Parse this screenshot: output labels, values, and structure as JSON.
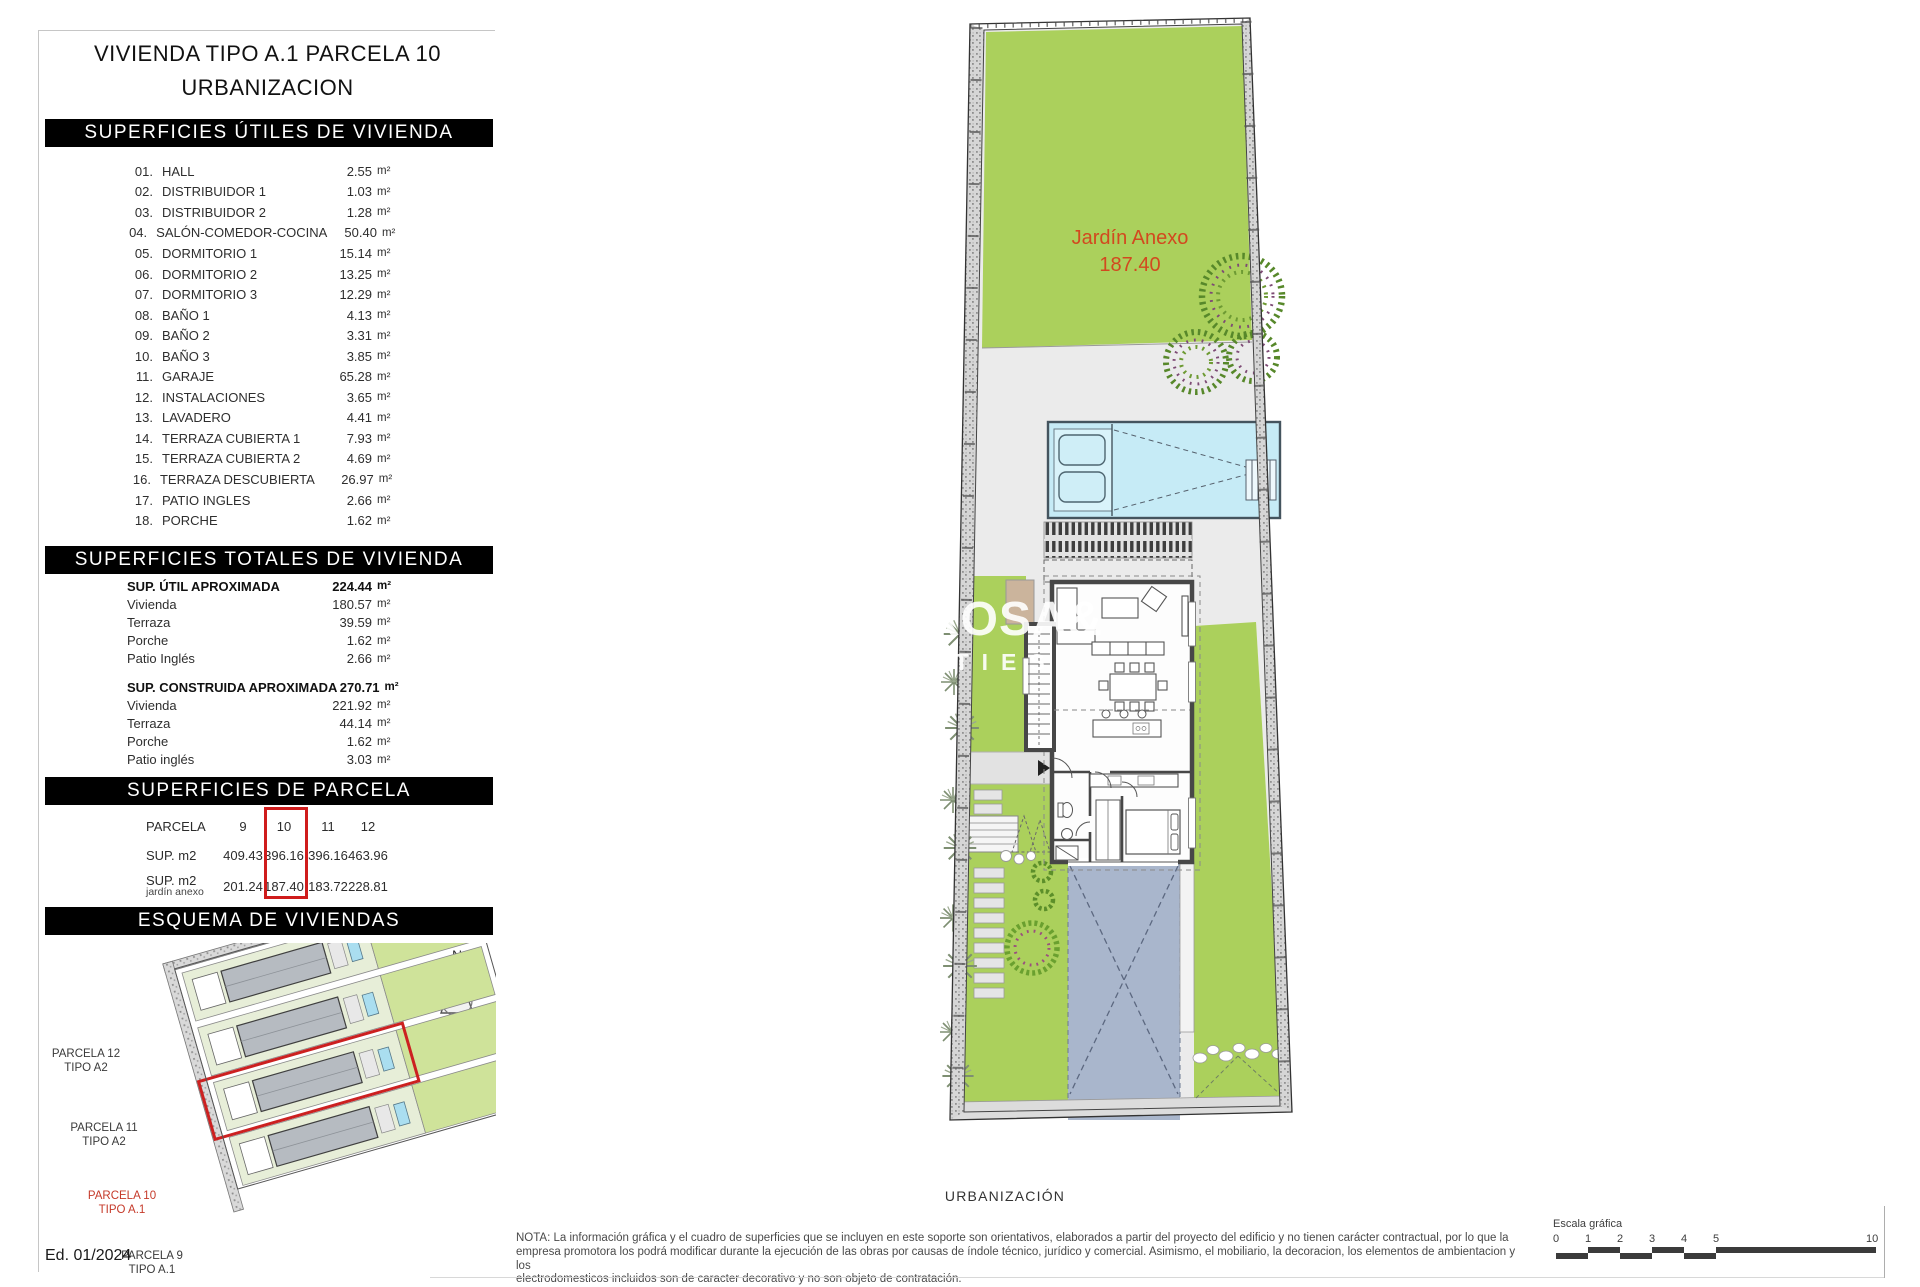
{
  "title": {
    "line1": "VIVIENDA TIPO A.1 PARCELA 10",
    "line2": "URBANIZACION"
  },
  "units": {
    "m2": "m²"
  },
  "utiles": {
    "header": "SUPERFICIES ÚTILES DE VIVIENDA",
    "rooms": [
      {
        "num": "01.",
        "label": "HALL",
        "value": "2.55"
      },
      {
        "num": "02.",
        "label": "DISTRIBUIDOR 1",
        "value": "1.03"
      },
      {
        "num": "03.",
        "label": "DISTRIBUIDOR 2",
        "value": "1.28"
      },
      {
        "num": "04.",
        "label": "SALÓN-COMEDOR-COCINA",
        "value": "50.40"
      },
      {
        "num": "05.",
        "label": "DORMITORIO 1",
        "value": "15.14"
      },
      {
        "num": "06.",
        "label": "DORMITORIO 2",
        "value": "13.25"
      },
      {
        "num": "07.",
        "label": "DORMITORIO 3",
        "value": "12.29"
      },
      {
        "num": "08.",
        "label": "BAÑO 1",
        "value": "4.13"
      },
      {
        "num": "09.",
        "label": "BAÑO 2",
        "value": "3.31"
      },
      {
        "num": "10.",
        "label": "BAÑO 3",
        "value": "3.85"
      },
      {
        "num": "11.",
        "label": "GARAJE",
        "value": "65.28"
      },
      {
        "num": "12.",
        "label": "INSTALACIONES",
        "value": "3.65"
      },
      {
        "num": "13.",
        "label": "LAVADERO",
        "value": "4.41"
      },
      {
        "num": "14.",
        "label": "TERRAZA CUBIERTA 1",
        "value": "7.93"
      },
      {
        "num": "15.",
        "label": "TERRAZA CUBIERTA 2",
        "value": "4.69"
      },
      {
        "num": "16.",
        "label": "TERRAZA DESCUBIERTA",
        "value": "26.97"
      },
      {
        "num": "17.",
        "label": "PATIO INGLES",
        "value": "2.66"
      },
      {
        "num": "18.",
        "label": "PORCHE",
        "value": "1.62"
      }
    ]
  },
  "totales": {
    "header": "SUPERFICIES TOTALES DE VIVIENDA",
    "groups": [
      {
        "label": "SUP. ÚTIL APROXIMADA",
        "value": "224.44",
        "rows": [
          {
            "label": "Vivienda",
            "value": "180.57"
          },
          {
            "label": "Terraza",
            "value": "39.59"
          },
          {
            "label": "Porche",
            "value": "1.62"
          },
          {
            "label": "Patio Inglés",
            "value": "2.66"
          }
        ]
      },
      {
        "label": "SUP. CONSTRUIDA APROXIMADA",
        "value": "270.71",
        "rows": [
          {
            "label": "Vivienda",
            "value": "221.92"
          },
          {
            "label": "Terraza",
            "value": "44.14"
          },
          {
            "label": "Porche",
            "value": "1.62"
          },
          {
            "label": "Patio inglés",
            "value": "3.03"
          }
        ]
      }
    ]
  },
  "parcela": {
    "header": "SUPERFICIES DE PARCELA",
    "row_header": "PARCELA",
    "columns": [
      "9",
      "10",
      "11",
      "12"
    ],
    "highlighted_column": "10",
    "sup_label": "SUP. m2",
    "sup_values": [
      "409.43",
      "396.16",
      "396.16",
      "463.96"
    ],
    "jardin_label": "SUP. m2",
    "jardin_sublabel": "jardín anexo",
    "jardin_values": [
      "201.24",
      "187.40",
      "183.72",
      "228.81"
    ]
  },
  "esquema": {
    "header": "ESQUEMA DE VIVIENDAS",
    "compass": "N",
    "parcels": [
      {
        "line1": "PARCELA 12",
        "line2": "TIPO A2"
      },
      {
        "line1": "PARCELA 11",
        "line2": "TIPO A2"
      },
      {
        "line1": "PARCELA 10",
        "line2": "TIPO A.1"
      },
      {
        "line1": "PARCELA 9",
        "line2": "TIPO A.1"
      }
    ]
  },
  "plan": {
    "garden_label": "Jardín Anexo",
    "garden_value": "187.40",
    "caption": "URBANIZACIÓN",
    "watermark_line1": "ROSA&",
    "watermark_line2": "RTIES"
  },
  "footer": {
    "edition": "Ed. 01/2024",
    "note_lines": [
      "NOTA: La información gráfica y el cuadro de superficies que se incluyen en este soporte son orientativos, elaborados a partir del proyecto del edificio y no tienen carácter contractual, por lo que la",
      "empresa promotora los podrá modificar durante la ejecución de las obras por causas de índole técnico, jurídico y comercial. Asimismo, el mobiliario, la decoracion, los elementos de ambientacion y los",
      "electrodomesticos incluidos son de caracter decorativo y no son objeto de contratación."
    ],
    "scale_label": "Escala gráfica",
    "scale_ticks": [
      "0",
      "1",
      "2",
      "3",
      "4",
      "5",
      "10"
    ]
  },
  "colors": {
    "garden_green": "#abd05c",
    "pool_blue": "#c6ebf6",
    "driveway_blue_gray": "#a9b6cc",
    "wall_gray": "#474747",
    "accent_red": "#cf1c1c",
    "garden_label_red": "#d2491f",
    "header_bg": "#000000"
  }
}
